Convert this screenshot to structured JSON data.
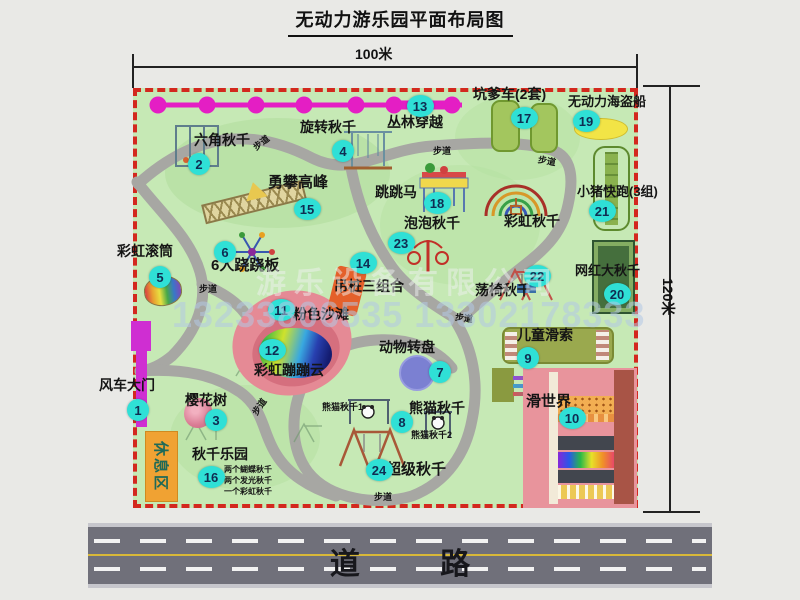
{
  "title": "无动力游乐园平面布局图",
  "scale": {
    "top": "100米",
    "right": "120米"
  },
  "road": {
    "label": "道 路"
  },
  "watermark": {
    "company": "游乐设备有限公司",
    "phone": "13233806535 13302178333"
  },
  "rest_area": {
    "label": "休息区"
  },
  "colors": {
    "park_green": "#c6e9b5",
    "border_red": "#d3281e",
    "path_gray": "#a7a7a3",
    "badge_teal": "#2fe0d6",
    "badge_text": "#0f2d52",
    "magenta_chain": "#e41ec4",
    "gate_magenta": "#cf2ed2",
    "rest_orange": "#f0a233",
    "road_gray": "#70707a"
  },
  "map": {
    "badges": [
      {
        "n": 1,
        "x": 138,
        "y": 410
      },
      {
        "n": 2,
        "x": 199,
        "y": 164
      },
      {
        "n": 3,
        "x": 216,
        "y": 420
      },
      {
        "n": 4,
        "x": 343,
        "y": 151
      },
      {
        "n": 5,
        "x": 160,
        "y": 277
      },
      {
        "n": 6,
        "x": 225,
        "y": 252
      },
      {
        "n": 7,
        "x": 440,
        "y": 372
      },
      {
        "n": 8,
        "x": 402,
        "y": 422
      },
      {
        "n": 9,
        "x": 528,
        "y": 358
      },
      {
        "n": 10,
        "x": 572,
        "y": 418
      },
      {
        "n": 11,
        "x": 281,
        "y": 310
      },
      {
        "n": 12,
        "x": 272,
        "y": 350
      },
      {
        "n": 13,
        "x": 420,
        "y": 106
      },
      {
        "n": 14,
        "x": 363,
        "y": 263
      },
      {
        "n": 15,
        "x": 307,
        "y": 209
      },
      {
        "n": 16,
        "x": 211,
        "y": 477
      },
      {
        "n": 17,
        "x": 524,
        "y": 118
      },
      {
        "n": 18,
        "x": 437,
        "y": 203
      },
      {
        "n": 19,
        "x": 586,
        "y": 121
      },
      {
        "n": 20,
        "x": 617,
        "y": 294
      },
      {
        "n": 21,
        "x": 602,
        "y": 211
      },
      {
        "n": 22,
        "x": 537,
        "y": 276
      },
      {
        "n": 23,
        "x": 401,
        "y": 243
      },
      {
        "n": 24,
        "x": 379,
        "y": 470
      }
    ],
    "labels": [
      {
        "t": "六角秋千",
        "x": 194,
        "y": 130,
        "fs": 14
      },
      {
        "t": "旋转秋千",
        "x": 300,
        "y": 117,
        "fs": 14
      },
      {
        "t": "勇攀高峰",
        "x": 268,
        "y": 171,
        "fs": 15
      },
      {
        "t": "丛林穿越",
        "x": 387,
        "y": 112,
        "fs": 14
      },
      {
        "t": "坑爹车(2套)",
        "x": 473,
        "y": 84,
        "fs": 14
      },
      {
        "t": "无动力海盗船",
        "x": 568,
        "y": 91,
        "fs": 13
      },
      {
        "t": "小猪快跑(3组)",
        "x": 577,
        "y": 181,
        "fs": 13
      },
      {
        "t": "网红大秋千",
        "x": 575,
        "y": 260,
        "fs": 13
      },
      {
        "t": "彩虹秋千",
        "x": 504,
        "y": 211,
        "fs": 14
      },
      {
        "t": "跳跳马",
        "x": 375,
        "y": 182,
        "fs": 14
      },
      {
        "t": "泡泡秋千",
        "x": 404,
        "y": 213,
        "fs": 14
      },
      {
        "t": "彩虹滚筒",
        "x": 117,
        "y": 241,
        "fs": 14
      },
      {
        "t": "6人跷跷板",
        "x": 211,
        "y": 254,
        "fs": 15
      },
      {
        "t": "吊桩三组合",
        "x": 334,
        "y": 276,
        "fs": 14
      },
      {
        "t": "荡椅秋千",
        "x": 475,
        "y": 280,
        "fs": 14
      },
      {
        "t": "粉色沙滩",
        "x": 293,
        "y": 304,
        "fs": 14
      },
      {
        "t": "彩虹蹦蹦云",
        "x": 254,
        "y": 360,
        "fs": 14
      },
      {
        "t": "风车大门",
        "x": 99,
        "y": 375,
        "fs": 14
      },
      {
        "t": "樱花树",
        "x": 185,
        "y": 390,
        "fs": 14
      },
      {
        "t": "动物转盘",
        "x": 379,
        "y": 337,
        "fs": 14
      },
      {
        "t": "熊猫秋千",
        "x": 409,
        "y": 398,
        "fs": 14
      },
      {
        "t": "熊猫秋千1",
        "x": 322,
        "y": 400,
        "fs": 9
      },
      {
        "t": "熊猫秋千2",
        "x": 411,
        "y": 428,
        "fs": 9
      },
      {
        "t": "儿童滑索",
        "x": 517,
        "y": 325,
        "fs": 14
      },
      {
        "t": "滑世界",
        "x": 526,
        "y": 390,
        "fs": 15
      },
      {
        "t": "秋千乐园",
        "x": 192,
        "y": 444,
        "fs": 14
      },
      {
        "t": "两个蝴蝶秋千",
        "x": 224,
        "y": 464,
        "fs": 8
      },
      {
        "t": "两个发光秋千",
        "x": 224,
        "y": 475,
        "fs": 8
      },
      {
        "t": "一个彩虹秋千",
        "x": 224,
        "y": 486,
        "fs": 8
      },
      {
        "t": "超级秋千",
        "x": 386,
        "y": 458,
        "fs": 15
      },
      {
        "t": "步道",
        "x": 252,
        "y": 136,
        "fs": 9,
        "rot": -38
      },
      {
        "t": "步道",
        "x": 433,
        "y": 144,
        "fs": 9
      },
      {
        "t": "步道",
        "x": 538,
        "y": 154,
        "fs": 9,
        "rot": 10
      },
      {
        "t": "步道",
        "x": 199,
        "y": 282,
        "fs": 9
      },
      {
        "t": "步道",
        "x": 455,
        "y": 311,
        "fs": 9,
        "rot": 8
      },
      {
        "t": "步道",
        "x": 250,
        "y": 400,
        "fs": 9,
        "rot": -55
      },
      {
        "t": "步道",
        "x": 374,
        "y": 490,
        "fs": 9
      }
    ],
    "icons": [
      "jungle-crossing-chain",
      "hex-swing",
      "rotating-swing",
      "climbing-lattice",
      "jumping-horse",
      "rainbow-swing-arcs",
      "bubble-swing",
      "seesaw-6p",
      "rainbow-roller",
      "hanging-piles",
      "swing-chair",
      "panda-swing-1",
      "panda-swing-2",
      "super-swing",
      "cherry-tree",
      "pink-beach",
      "bounce-cloud",
      "animal-carousel",
      "kids-zipline",
      "slide-world",
      "pirate-ship",
      "pit-cart-tracks",
      "piggy-run-track",
      "big-swing-frame",
      "windmill-gate",
      "rest-area"
    ]
  }
}
